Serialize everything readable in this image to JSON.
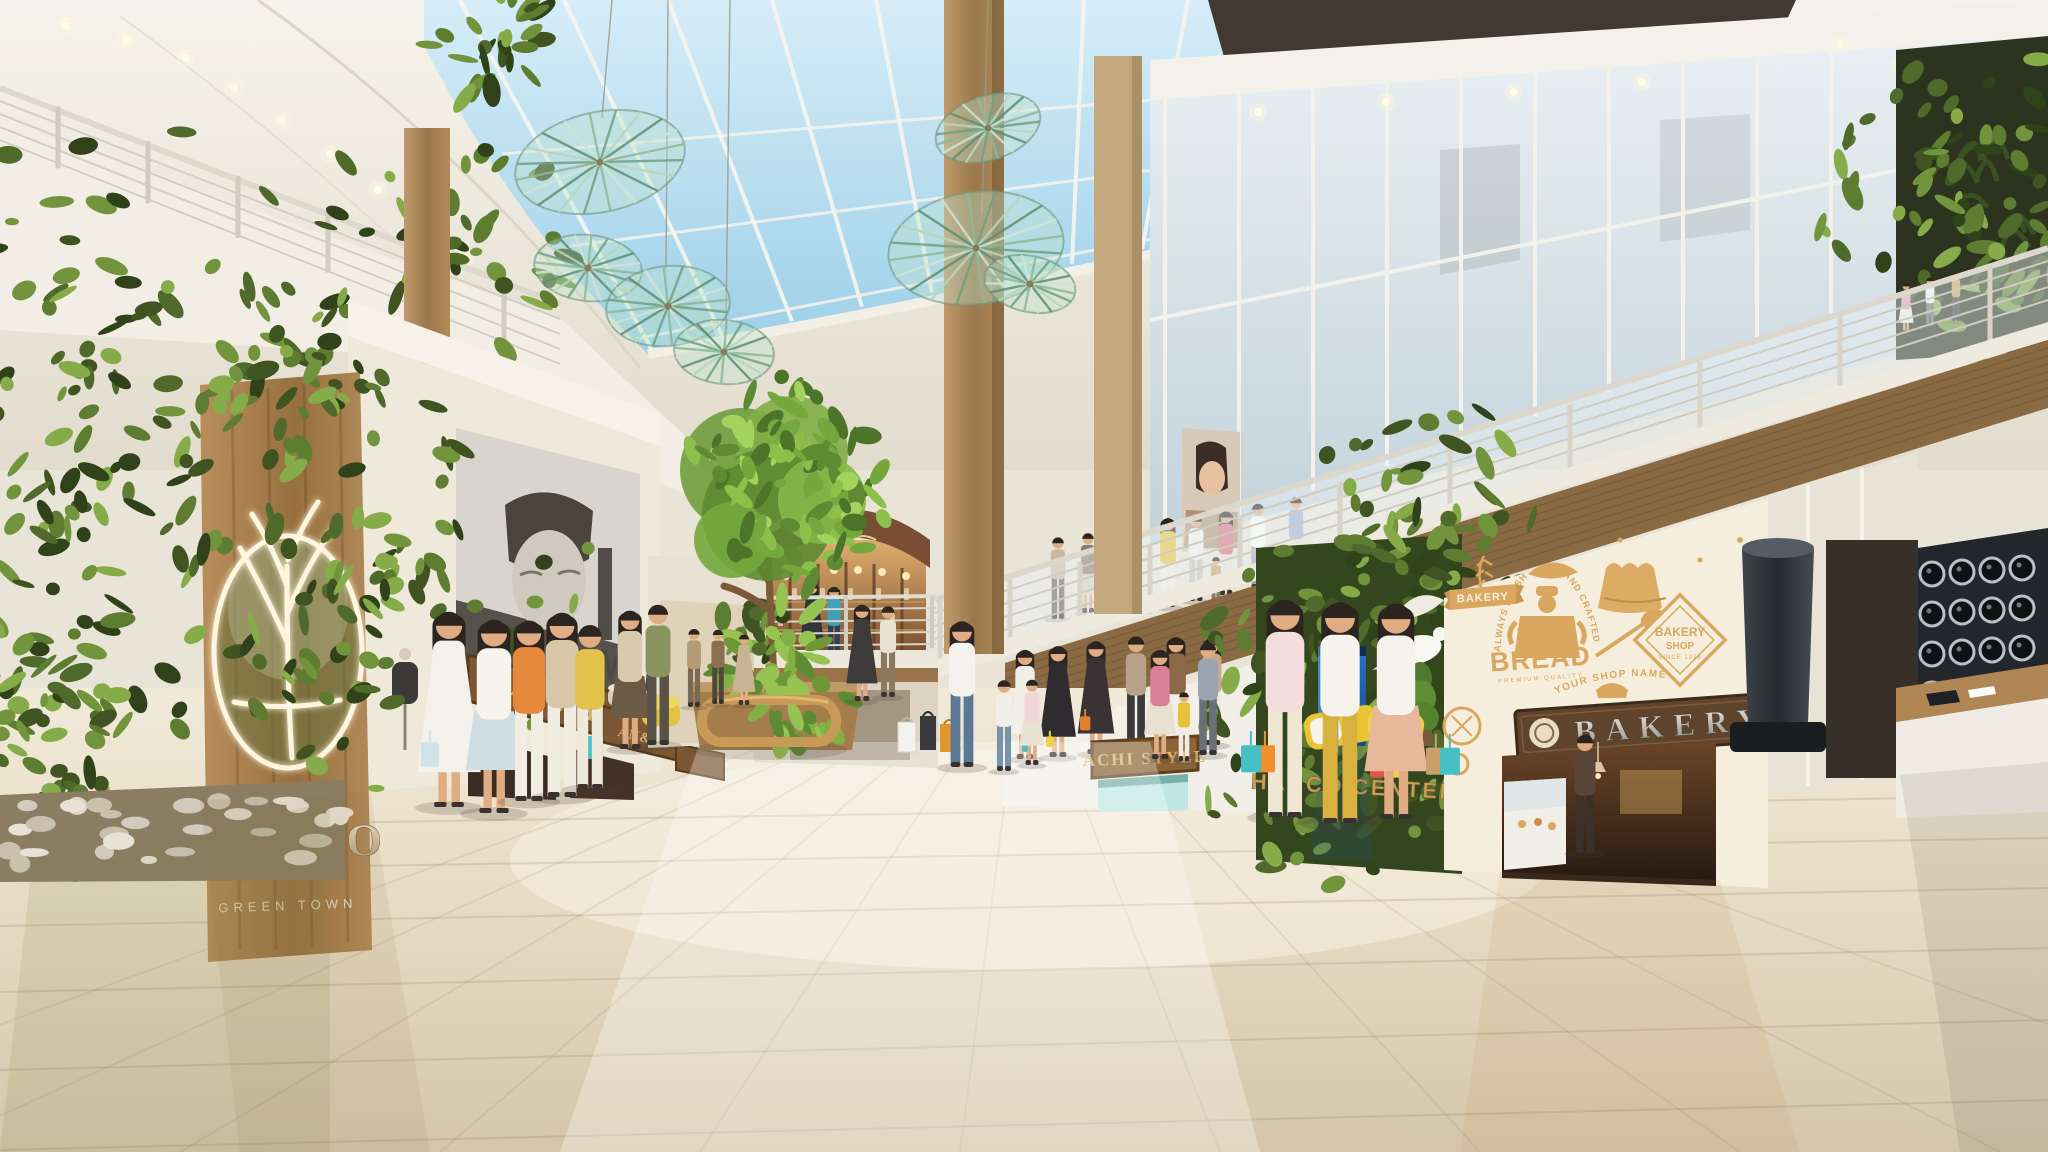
{
  "meta": {
    "title": "Hanco Green Town shopping mall atrium"
  },
  "palette": {
    "sky": "#bfe0f2",
    "ceiling": "#f3efe7",
    "green_dark": "#3f5421",
    "green_mid": "#5e7d31",
    "green_light": "#86ab49",
    "wood": "#a97f4f",
    "floor_light": "#f0e9da",
    "floor_dark": "#d8caaf",
    "bakery_tan": "#d9a75f",
    "bakery_cream": "#f6eedd",
    "pepsi_blue": "#1d63b0",
    "accent_yellow": "#e8c437",
    "accent_teal": "#46c0c4",
    "accent_orange": "#ef8f2e"
  },
  "signs": {
    "hanco_logo_title": "HANCO",
    "hanco_logo_subtitle": "GREEN TOWN",
    "man_poster_title": "MAN",
    "man_poster_subtitle": "FASHION",
    "shop_sign_left_1": "MAN STYLE",
    "shop_sign_left_2": "AN&GI",
    "achi_style": "ACHI STYLE",
    "hanco_center": "HANCO CENTER",
    "bakery_plaque": "BAKERY",
    "pepsi": "pepsi"
  },
  "bakery_wall": {
    "ribbon": "BAKERY",
    "arc_left": "ALWAYS FRESH",
    "arc_right": "HAND CRAFTED",
    "bread": "BREAD",
    "bread_sub": "PREMIUM QUALITY",
    "shop_name_arc": "YOUR SHOP NAME",
    "badge_line1": "BAKERY",
    "badge_line2": "SHOP",
    "badge_line3": "SINCE 1978"
  },
  "decor": {
    "palettes": {
      "wall": [
        "#3f5421",
        "#4f6a2a",
        "#5e7d31",
        "#72943c",
        "#86ab49",
        "#2f421a"
      ],
      "bush": [
        "#6d9838",
        "#82b044",
        "#97c353",
        "#5d8a32"
      ],
      "tree": [
        "#5d8a32",
        "#74a73d",
        "#8cc04b",
        "#a3d55e",
        "#4c7529"
      ]
    },
    "leaf_regions": [
      {
        "g": "g-leftgreen",
        "x": 0,
        "y": 128,
        "w": 202,
        "h": 700,
        "n": 170,
        "p": "wall"
      },
      {
        "g": "g-leftgreen",
        "x": 0,
        "y": 620,
        "w": 150,
        "h": 250,
        "n": 70,
        "p": "wall"
      },
      {
        "g": "g-leftgreen",
        "x": 195,
        "y": 336,
        "w": 185,
        "h": 58,
        "n": 42,
        "p": "wall"
      },
      {
        "g": "g-leftgreen",
        "x": 362,
        "y": 382,
        "w": 52,
        "h": 408,
        "n": 66,
        "p": "wall"
      },
      {
        "g": "g-pillar-leaves",
        "x": 1258,
        "y": 540,
        "w": 202,
        "h": 326,
        "n": 130,
        "p": "wall"
      },
      {
        "g": "g-pillar-leaves",
        "x": 1392,
        "y": 390,
        "w": 76,
        "h": 260,
        "n": 52,
        "p": "wall"
      },
      {
        "g": "g-topright-leaves",
        "x": 1902,
        "y": 58,
        "w": 146,
        "h": 290,
        "n": 85,
        "p": "wall"
      },
      {
        "g": "g-leftmezz-plants",
        "x": 318,
        "y": 210,
        "w": 252,
        "h": 62,
        "n": 48,
        "p": "wall"
      },
      {
        "g": "g-leftmezz-plants",
        "x": 420,
        "y": 24,
        "w": 150,
        "h": 48,
        "n": 26,
        "p": "wall"
      },
      {
        "g": "g-boutique-plant",
        "x": 736,
        "y": 598,
        "w": 44,
        "h": 72,
        "n": 18,
        "p": "wall"
      },
      {
        "g": "g-bushes",
        "x": 698,
        "y": 644,
        "w": 166,
        "h": 50,
        "n": 52,
        "p": "bush"
      },
      {
        "g": "g-tree-leaves",
        "x": 698,
        "y": 402,
        "w": 176,
        "h": 165,
        "n": 95,
        "p": "tree"
      }
    ],
    "discs": [
      [
        600,
        162,
        86,
        50,
        -12
      ],
      [
        588,
        268,
        54,
        33,
        6
      ],
      [
        668,
        306,
        62,
        40,
        -6
      ],
      [
        724,
        352,
        50,
        32,
        5
      ],
      [
        988,
        128,
        54,
        32,
        -18
      ],
      [
        976,
        248,
        88,
        56,
        -8
      ],
      [
        1030,
        284,
        46,
        28,
        12
      ]
    ],
    "disc_cables": [
      [
        612,
        0,
        602,
        118
      ],
      [
        668,
        0,
        666,
        268
      ],
      [
        730,
        0,
        726,
        324
      ],
      [
        988,
        0,
        982,
        214
      ]
    ],
    "lens_grid": {
      "x0": 1932,
      "y0": 574,
      "dx": 30,
      "dy": 40,
      "cols": 4,
      "rows": 5,
      "r": 12
    },
    "pebbles": {
      "n": 30
    },
    "bottles": {
      "n": 10
    }
  },
  "figures": [
    {
      "g": "g-people-ground",
      "x": 449,
      "y": 806,
      "h": 212,
      "k": "d",
      "top": "#f4f1ea",
      "bot": "#f4f1ea",
      "long": true,
      "bags": [
        {
          "dx": -28,
          "c": "#cfe4ea"
        }
      ]
    },
    {
      "g": "g-people-ground",
      "x": 494,
      "y": 812,
      "h": 210,
      "k": "s",
      "top": "#f7f4ee",
      "bot": "#cfdde4",
      "long": true
    },
    {
      "g": "g-people-ground",
      "x": 529,
      "y": 800,
      "h": 196,
      "k": "p",
      "top": "#e5893b",
      "bot": "#f2ede2",
      "long": true
    },
    {
      "g": "g-people-ground",
      "x": 562,
      "y": 796,
      "h": 200,
      "k": "p",
      "top": "#d9c8a8",
      "bot": "#f0ece2",
      "long": true,
      "bags": [
        {
          "dx": 24,
          "c": "#46c0c4"
        }
      ]
    },
    {
      "g": "g-people-ground",
      "x": 590,
      "y": 788,
      "h": 178,
      "k": "p",
      "top": "#e3c14a",
      "bot": "#efe9dc"
    },
    {
      "g": "g-people-ground",
      "x": 630,
      "y": 748,
      "h": 150,
      "k": "s",
      "top": "#d9c9ae",
      "bot": "#6b5a44",
      "long": true
    },
    {
      "g": "g-people-ground",
      "x": 658,
      "y": 744,
      "h": 152,
      "k": "p",
      "top": "#8a9460",
      "bot": "#5a5248"
    },
    {
      "g": "g-people-ground",
      "x": 694,
      "y": 706,
      "h": 84,
      "k": "p",
      "top": "#b59a78",
      "bot": "#7a6a55"
    },
    {
      "g": "g-people-ground",
      "x": 718,
      "y": 703,
      "h": 80,
      "k": "p",
      "top": "#8a6f52",
      "bot": "#4f463c"
    },
    {
      "g": "g-people-ground",
      "x": 744,
      "y": 704,
      "h": 76,
      "k": "d",
      "top": "#c9b393",
      "bot": "#c9b393"
    },
    {
      "g": "g-people-ground",
      "x": 862,
      "y": 700,
      "h": 104,
      "k": "d",
      "top": "#3c3a3a",
      "bot": "#3c3a3a",
      "long": true
    },
    {
      "g": "g-people-ground",
      "x": 888,
      "y": 696,
      "h": 98,
      "k": "p",
      "top": "#e8e2d4",
      "bot": "#8a7a62"
    },
    {
      "g": "g-people-ground",
      "x": 962,
      "y": 766,
      "h": 158,
      "k": "p",
      "top": "#f4f2ec",
      "bot": "#5d7894",
      "long": true
    },
    {
      "g": "g-people-ground",
      "x": 1004,
      "y": 770,
      "h": 98,
      "k": "p",
      "top": "#f2efe8",
      "bot": "#7a93ac",
      "bags": [
        {
          "dx": 18,
          "c": "#46c0c4"
        }
      ]
    },
    {
      "g": "g-people-ground",
      "x": 1032,
      "y": 764,
      "h": 92,
      "k": "s",
      "top": "#f0d8da",
      "bot": "#e8e2d2",
      "bags": [
        {
          "dx": 14,
          "c": "#f2d049"
        }
      ]
    },
    {
      "g": "g-people-ground",
      "x": 1160,
      "y": 758,
      "h": 118,
      "k": "s",
      "top": "#d87f9a",
      "bot": "#e8e0d0",
      "long": true
    },
    {
      "g": "g-people-ground",
      "x": 1184,
      "y": 760,
      "h": 74,
      "k": "p",
      "top": "#e8c33a",
      "bot": "#f0ece2"
    },
    {
      "g": "g-people-ground",
      "x": 1208,
      "y": 754,
      "h": 122,
      "k": "p",
      "top": "#9aa4b0",
      "bot": "#6a7078"
    },
    {
      "g": "g-people-ground",
      "x": 1332,
      "y": 756,
      "h": 88,
      "k": "p",
      "top": "#ecebe4",
      "bot": "#7a93ac"
    },
    {
      "g": "g-people-ground",
      "x": 1285,
      "y": 816,
      "h": 236,
      "k": "p",
      "top": "#f3dddd",
      "bot": "#efe7d4",
      "long": true,
      "bags": [
        {
          "dx": -30,
          "c": "#ef8f2e"
        },
        {
          "dx": -44,
          "c": "#46c0c4"
        }
      ]
    },
    {
      "g": "g-people-ground",
      "x": 1340,
      "y": 822,
      "h": 240,
      "k": "p",
      "top": "#f6f3ec",
      "bot": "#d9b13f",
      "long": true,
      "bags": [
        {
          "dx": 30,
          "c": "#e2574b"
        },
        {
          "dx": 44,
          "c": "#f2d049"
        }
      ]
    },
    {
      "g": "g-people-ground",
      "x": 1396,
      "y": 818,
      "h": 234,
      "k": "s",
      "top": "#f6f3ee",
      "bot": "#e8b89c",
      "long": true,
      "bags": [
        {
          "dx": 30,
          "c": "#caa06a"
        },
        {
          "dx": 44,
          "c": "#46c0c4"
        }
      ]
    },
    {
      "g": "g-people-ground",
      "x": 1585,
      "y": 852,
      "h": 128,
      "k": "p",
      "top": "#5a4638",
      "bot": "#3c3028"
    },
    {
      "g": "g-balcony-people",
      "x": 1168,
      "y": 606,
      "h": 96,
      "k": "p",
      "top": "#e8c33a",
      "bot": "#f0ece0",
      "long": true
    },
    {
      "g": "g-balcony-people",
      "x": 1196,
      "y": 600,
      "h": 92,
      "k": "p",
      "top": "#f2f0ea",
      "bot": "#c9c2b4"
    },
    {
      "g": "g-balcony-people",
      "x": 1226,
      "y": 594,
      "h": 90,
      "k": "s",
      "top": "#d8707a",
      "bot": "#e8e2d4",
      "long": true
    },
    {
      "g": "g-balcony-people",
      "x": 1258,
      "y": 588,
      "h": 92,
      "k": "p",
      "top": "#fafaf6",
      "bot": "#9aa4ae"
    },
    {
      "g": "g-balcony-people",
      "x": 1296,
      "y": 578,
      "h": 88,
      "k": "p",
      "top": "#9ab0d8",
      "bot": "#e8e2d4"
    },
    {
      "g": "g-balcony-people",
      "x": 1216,
      "y": 612,
      "h": 60,
      "k": "p",
      "top": "#caa05a",
      "bot": "#8a7a62"
    },
    {
      "g": "g-balcony-people",
      "x": 1906,
      "y": 334,
      "h": 56,
      "k": "s",
      "top": "#e2a0a8",
      "bot": "#f0ece4"
    },
    {
      "g": "g-balcony-people",
      "x": 1930,
      "y": 327,
      "h": 54,
      "k": "p",
      "top": "#f0eee8",
      "bot": "#6a7078"
    },
    {
      "g": "g-balcony-people",
      "x": 1956,
      "y": 320,
      "h": 52,
      "k": "p",
      "top": "#caa05a",
      "bot": "#4a4440"
    },
    {
      "g": "g-mezzpeople",
      "x": 1058,
      "y": 618,
      "h": 88,
      "k": "p",
      "top": "#c9b9a2",
      "bot": "#6b5f50"
    },
    {
      "g": "g-mezzpeople",
      "x": 1088,
      "y": 612,
      "h": 86,
      "k": "s",
      "top": "#8a7a68",
      "bot": "#d8d0c2"
    },
    {
      "g": "g-mezzpeople",
      "x": 1118,
      "y": 606,
      "h": 84,
      "k": "p",
      "top": "#e0d8cc",
      "bot": "#8a6a4a"
    },
    {
      "g": "g-boutique-people",
      "x": 812,
      "y": 660,
      "h": 84,
      "k": "d",
      "top": "#33343a",
      "bot": "#33343a",
      "long": true
    },
    {
      "g": "g-boutique-people",
      "x": 834,
      "y": 662,
      "h": 82,
      "k": "p",
      "top": "#3fa0b8",
      "bot": "#2e3e5a",
      "long": true
    },
    {
      "g": "g-models",
      "x": 1025,
      "y": 758,
      "h": 118,
      "k": "s",
      "top": "#f2efe8",
      "bot": "#f2efe8",
      "long": true
    },
    {
      "g": "g-models",
      "x": 1058,
      "y": 756,
      "h": 120,
      "k": "d",
      "top": "#2e2c2e",
      "bot": "#2e2c2e",
      "long": true
    },
    {
      "g": "g-models",
      "x": 1096,
      "y": 753,
      "h": 122,
      "k": "d",
      "top": "#3a3336",
      "bot": "#3a3336",
      "long": true,
      "bags": [
        {
          "dx": -16,
          "c": "#e0812f"
        }
      ]
    },
    {
      "g": "g-models",
      "x": 1136,
      "y": 750,
      "h": 124,
      "k": "p",
      "top": "#b8a08a",
      "bot": "#3a3a3c"
    },
    {
      "g": "g-models",
      "x": 1176,
      "y": 747,
      "h": 120,
      "k": "p",
      "top": "#8a6848",
      "bot": "#f0ede6",
      "long": true
    },
    {
      "g": "g-models",
      "x": 1212,
      "y": 744,
      "h": 116,
      "k": "p",
      "top": "#caa890",
      "bot": "#efe9dc",
      "long": true
    }
  ]
}
